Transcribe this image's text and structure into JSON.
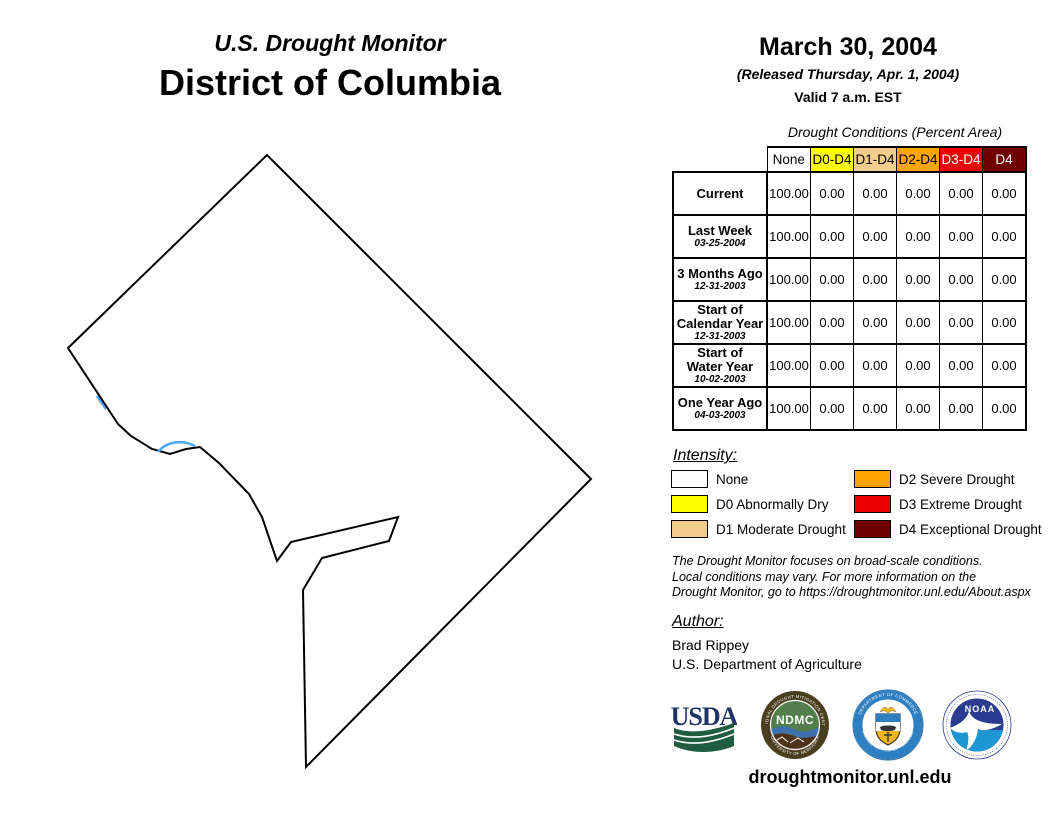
{
  "header": {
    "kicker": "U.S. Drought Monitor",
    "region": "District of Columbia",
    "date": "March 30, 2004",
    "released": "(Released Thursday, Apr. 1, 2004)",
    "valid": "Valid 7 a.m. EST"
  },
  "table": {
    "title": "Drought Conditions (Percent Area)",
    "columns": [
      "None",
      "D0-D4",
      "D1-D4",
      "D2-D4",
      "D3-D4",
      "D4"
    ],
    "rows": [
      {
        "label": "Current",
        "label2": "",
        "sublabel": "",
        "values": [
          "100.00",
          "0.00",
          "0.00",
          "0.00",
          "0.00",
          "0.00"
        ]
      },
      {
        "label": "Last Week",
        "label2": "",
        "sublabel": "03-25-2004",
        "values": [
          "100.00",
          "0.00",
          "0.00",
          "0.00",
          "0.00",
          "0.00"
        ]
      },
      {
        "label": "3 Months Ago",
        "label2": "",
        "sublabel": "12-31-2003",
        "values": [
          "100.00",
          "0.00",
          "0.00",
          "0.00",
          "0.00",
          "0.00"
        ]
      },
      {
        "label": "Start of",
        "label2": "Calendar Year",
        "sublabel": "12-31-2003",
        "values": [
          "100.00",
          "0.00",
          "0.00",
          "0.00",
          "0.00",
          "0.00"
        ]
      },
      {
        "label": "Start of",
        "label2": "Water Year",
        "sublabel": "10-02-2003",
        "values": [
          "100.00",
          "0.00",
          "0.00",
          "0.00",
          "0.00",
          "0.00"
        ]
      },
      {
        "label": "One Year Ago",
        "label2": "",
        "sublabel": "04-03-2003",
        "values": [
          "100.00",
          "0.00",
          "0.00",
          "0.00",
          "0.00",
          "0.00"
        ]
      }
    ]
  },
  "chart_data": {
    "type": "table",
    "title": "Drought Conditions (Percent Area)",
    "categories": [
      "None",
      "D0-D4",
      "D1-D4",
      "D2-D4",
      "D3-D4",
      "D4"
    ],
    "series": [
      {
        "name": "Current",
        "values": [
          100.0,
          0.0,
          0.0,
          0.0,
          0.0,
          0.0
        ]
      },
      {
        "name": "Last Week (03-25-2004)",
        "values": [
          100.0,
          0.0,
          0.0,
          0.0,
          0.0,
          0.0
        ]
      },
      {
        "name": "3 Months Ago (12-31-2003)",
        "values": [
          100.0,
          0.0,
          0.0,
          0.0,
          0.0,
          0.0
        ]
      },
      {
        "name": "Start of Calendar Year (12-31-2003)",
        "values": [
          100.0,
          0.0,
          0.0,
          0.0,
          0.0,
          0.0
        ]
      },
      {
        "name": "Start of Water Year (10-02-2003)",
        "values": [
          100.0,
          0.0,
          0.0,
          0.0,
          0.0,
          0.0
        ]
      },
      {
        "name": "One Year Ago (04-03-2003)",
        "values": [
          100.0,
          0.0,
          0.0,
          0.0,
          0.0,
          0.0
        ]
      }
    ]
  },
  "legend": {
    "heading": "Intensity:",
    "items": [
      {
        "label": "None",
        "color": "#FFFFFF"
      },
      {
        "label": "D0 Abnormally Dry",
        "color": "#FFFF00"
      },
      {
        "label": "D1 Moderate Drought",
        "color": "#F3CE8D"
      },
      {
        "label": "D2 Severe Drought",
        "color": "#FFA400"
      },
      {
        "label": "D3 Extreme Drought",
        "color": "#EE0000"
      },
      {
        "label": "D4 Exceptional Drought",
        "color": "#700000"
      }
    ]
  },
  "disclaimer": {
    "line1": "The Drought Monitor focuses on broad-scale conditions.",
    "line2": "Local conditions may vary. For more information on the",
    "line3": "Drought Monitor, go to https://droughtmonitor.unl.edu/About.aspx"
  },
  "author": {
    "heading": "Author:",
    "name": "Brad Rippey",
    "org": "U.S. Department of Agriculture"
  },
  "logos": {
    "usda": "USDA",
    "ndmc": "NDMC",
    "ndmc_ring_top": "NATIONAL DROUGHT MITIGATION CENTER",
    "ndmc_ring_bottom": "UNIVERSITY OF NEBRASKA",
    "doc_ring_top": "DEPARTMENT OF COMMERCE",
    "doc_ring_bottom": "UNITED STATES OF AMERICA",
    "noaa": "NOAA"
  },
  "footer": {
    "url": "droughtmonitor.unl.edu"
  },
  "colors": {
    "none": "#FFFFFF",
    "d0": "#FFFF00",
    "d1": "#F3CE8D",
    "d2": "#FFA400",
    "d3": "#EE0000",
    "d4": "#700000",
    "water": "#4DA6FF"
  }
}
